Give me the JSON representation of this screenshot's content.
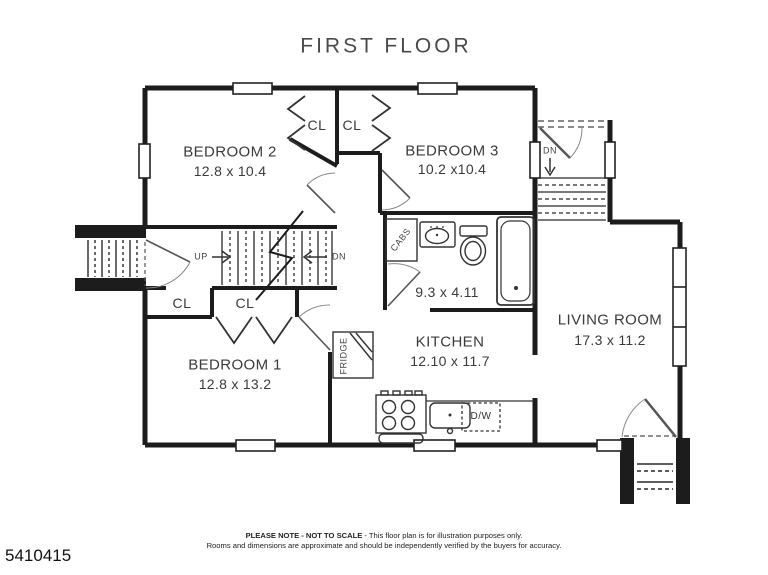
{
  "title": "FIRST FLOOR",
  "rooms": {
    "bedroom2": {
      "name": "BEDROOM 2",
      "dims": "12.8 x 10.4"
    },
    "bedroom3": {
      "name": "BEDROOM 3",
      "dims": "10.2 x10.4"
    },
    "bedroom1": {
      "name": "BEDROOM 1",
      "dims": "12.8 x 13.2"
    },
    "kitchen": {
      "name": "KITCHEN",
      "dims": "12.10 x 11.7"
    },
    "living_room": {
      "name": "LIVING ROOM",
      "dims": "17.3 x 11.2"
    },
    "bathroom": {
      "dims": "9.3 x 4.11"
    }
  },
  "labels": {
    "closet": "CL",
    "up": "UP",
    "down": "DN",
    "cabs": "CABS",
    "fridge": "FRIDGE",
    "dishwasher": "D/W"
  },
  "footer": {
    "note_bold": "PLEASE NOTE - NOT TO SCALE",
    "note_rest": " - This floor plan is for illustration purposes only.",
    "note_line2": "Rooms and dimensions are approximate and should be independently verified by the buyers for accuracy.",
    "listing_id": "5410415"
  },
  "colors": {
    "wall": "#1c1c1c",
    "text": "#3b3b3b",
    "background": "#ffffff"
  }
}
